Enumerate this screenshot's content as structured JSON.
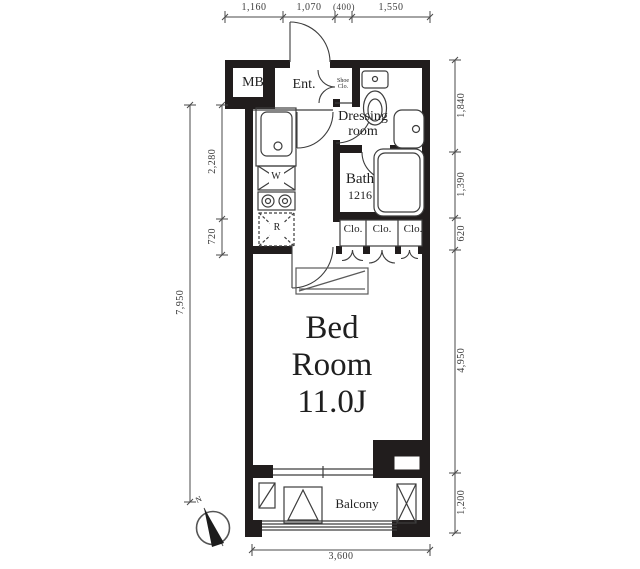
{
  "floorplan": {
    "rooms": {
      "mb": "MB",
      "ent": "Ent.",
      "shoe_line1": "Shoe",
      "shoe_line2": "Clo.",
      "dressing_line1": "Dressing",
      "dressing_line2": "room",
      "bath": "Bath",
      "bath_size": "1216",
      "clo_1": "Clo.",
      "clo_2": "Clo.",
      "clo_3": "Clo.",
      "bedroom_line1": "Bed",
      "bedroom_line2": "Room",
      "bedroom_size": "11.0J",
      "balcony": "Balcony"
    },
    "appliances": {
      "washer": "W",
      "fridge": "R"
    },
    "dimensions": {
      "top": {
        "d1": "1,160",
        "d2": "1,070",
        "d3": "(400)",
        "d4": "1,550"
      },
      "left": {
        "outer": "7,950",
        "inner1": "2,280",
        "inner2": "720"
      },
      "right": {
        "d1": "1,840",
        "d2": "1,390",
        "d3": "620",
        "d4": "4,950",
        "d5": "1,200"
      },
      "bottom": {
        "d1": "3,600"
      }
    },
    "compass": {
      "north": "N"
    },
    "colors": {
      "wall": "#211d1d",
      "line": "#3d3d3d",
      "dim": "#4a4a4a"
    }
  }
}
